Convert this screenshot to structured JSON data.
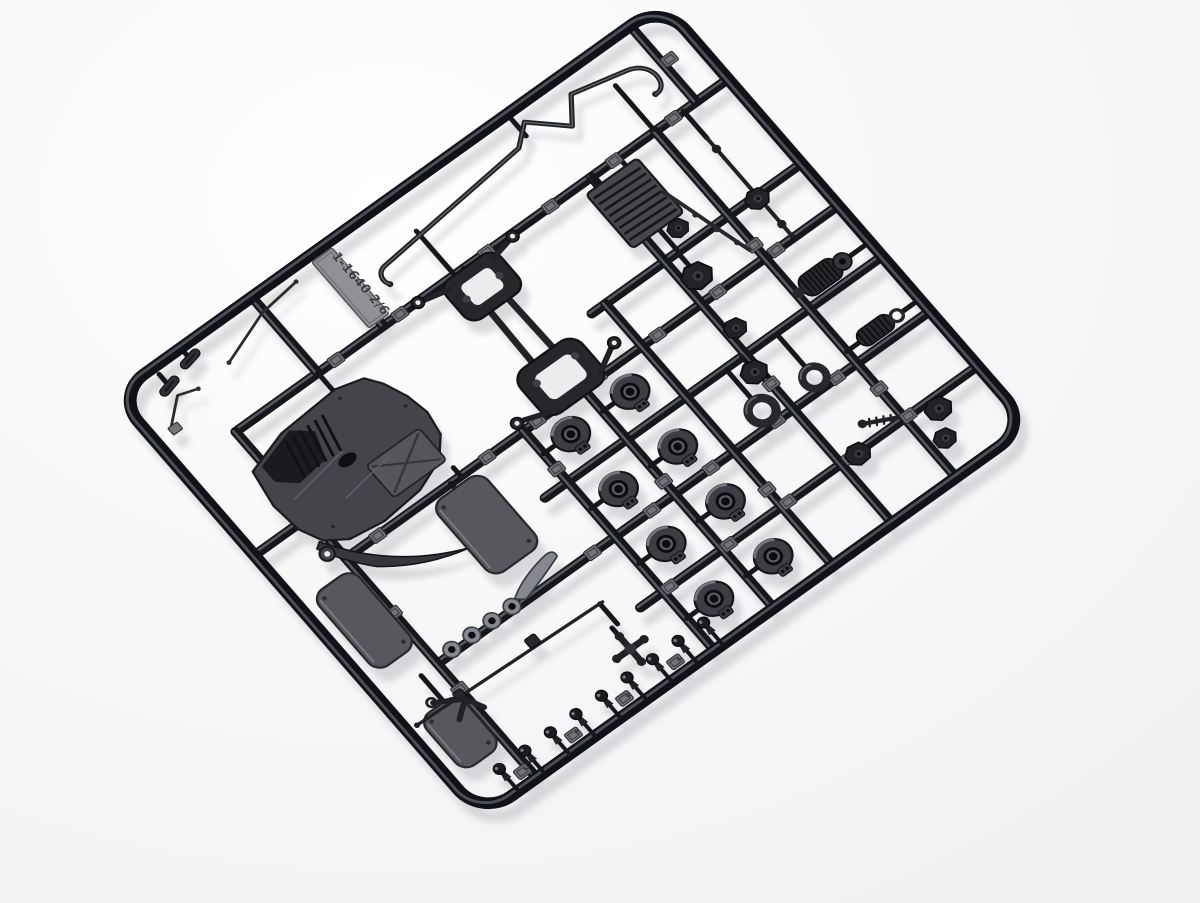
{
  "photo": {
    "description": "Black plastic model kit sprue with car chassis parts photographed on a white background",
    "tag_code": "1-1640 2/6",
    "pad_digits": [
      "2",
      "6",
      "9",
      "2"
    ]
  },
  "scene": {
    "width": 1200,
    "height": 903,
    "matrix": [
      0.9117,
      -0.6533,
      0.734,
      0.844,
      115,
      395
    ],
    "shadow_offset": [
      8,
      13
    ],
    "colors": {
      "bg_center": "#ffffff",
      "bg_edge": "#eff0f2",
      "shadow": "#b2b2b8",
      "runner": "#16171b",
      "runner_hi": "#565a62",
      "frame": "#111217",
      "dark": "#202226",
      "mid": "#34363b",
      "gray": "#46484d",
      "gray2": "#54565c",
      "light": "#7d8086",
      "pad": "#72747a",
      "pad_in": "#44464b",
      "tag_face": "#8f9195",
      "tag_text": "#3a3c40",
      "tag_emboss": "#c9cbcd",
      "cup": "#3c3e43",
      "cup_hi": "#73767d",
      "hole": "#0c0d10",
      "washer": "#85888e",
      "plate": "#56585d",
      "plate_hi": "#7b7e84",
      "bg_hole": "#ececee"
    },
    "frame": {
      "w": 600,
      "h": 500,
      "r": 32,
      "sw": 11
    },
    "runners": [
      [
        60,
        90,
        600,
        90
      ],
      [
        0,
        190,
        60,
        190
      ],
      [
        370,
        190,
        600,
        190
      ],
      [
        60,
        240,
        600,
        240
      ],
      [
        230,
        300,
        600,
        300
      ],
      [
        60,
        365,
        600,
        365
      ],
      [
        230,
        430,
        600,
        430
      ],
      [
        60,
        90,
        60,
        500
      ],
      [
        255,
        240,
        255,
        500
      ],
      [
        320,
        240,
        320,
        500
      ],
      [
        385,
        190,
        385,
        500
      ],
      [
        450,
        90,
        450,
        500
      ],
      [
        520,
        90,
        520,
        500
      ],
      [
        222,
        0,
        222,
        90
      ],
      [
        150,
        0,
        150,
        90
      ],
      [
        565,
        0,
        565,
        90
      ]
    ],
    "stubs": [
      [
        42,
        8,
        42,
        20
      ],
      [
        72,
        2,
        72,
        12
      ],
      [
        300,
        38,
        300,
        88
      ],
      [
        520,
        36,
        520,
        88
      ],
      [
        430,
        3,
        430,
        26
      ],
      [
        450,
        90,
        450,
        100
      ],
      [
        480,
        90,
        480,
        100
      ],
      [
        465,
        165,
        465,
        188
      ],
      [
        310,
        90,
        310,
        95
      ],
      [
        312,
        236,
        312,
        240
      ],
      [
        150,
        90,
        150,
        112
      ],
      [
        60,
        150,
        48,
        150
      ],
      [
        186,
        230,
        186,
        240
      ],
      [
        175,
        240,
        175,
        248
      ],
      [
        42,
        365,
        42,
        396
      ],
      [
        268,
        267,
        255,
        267
      ],
      [
        268,
        332,
        255,
        332
      ],
      [
        268,
        397,
        255,
        397
      ],
      [
        268,
        462,
        255,
        462
      ],
      [
        333,
        267,
        320,
        267
      ],
      [
        333,
        332,
        320,
        332
      ],
      [
        333,
        397,
        320,
        397
      ],
      [
        333,
        462,
        320,
        462
      ],
      [
        428,
        302,
        428,
        336
      ],
      [
        483,
        302,
        483,
        341
      ],
      [
        464,
        192,
        464,
        206
      ],
      [
        446,
        300,
        446,
        310
      ],
      [
        551,
        90,
        551,
        122
      ],
      [
        551,
        238,
        551,
        240
      ],
      [
        520,
        283,
        526,
        283
      ],
      [
        578,
        283,
        600,
        283
      ],
      [
        520,
        351,
        534,
        351
      ],
      [
        581,
        351,
        600,
        351
      ],
      [
        199,
        430,
        199,
        443
      ],
      [
        205,
        406,
        205,
        430
      ]
    ],
    "pads": [
      [
        170,
        90
      ],
      [
        240,
        90
      ],
      [
        335,
        90
      ],
      [
        405,
        90
      ],
      [
        475,
        90
      ],
      [
        540,
        90
      ],
      [
        95,
        240
      ],
      [
        215,
        240
      ],
      [
        270,
        240
      ],
      [
        337,
        240
      ],
      [
        402,
        240
      ],
      [
        468,
        240
      ],
      [
        532,
        240
      ],
      [
        230,
        365
      ],
      [
        295,
        365
      ],
      [
        360,
        365
      ],
      [
        432,
        365
      ],
      [
        498,
        365
      ],
      [
        262,
        430
      ],
      [
        327,
        430
      ],
      [
        392,
        430
      ],
      [
        460,
        430
      ],
      [
        524,
        430
      ],
      [
        60,
        140
      ],
      [
        60,
        305
      ],
      [
        60,
        395
      ],
      [
        255,
        285
      ],
      [
        320,
        350
      ],
      [
        385,
        410
      ],
      [
        450,
        155
      ],
      [
        520,
        225
      ],
      [
        450,
        335
      ],
      [
        520,
        395
      ],
      [
        572,
        45
      ],
      [
        54,
        488,
        0
      ],
      [
        110,
        488,
        1
      ],
      [
        166,
        488,
        2
      ],
      [
        222,
        488,
        3
      ]
    ],
    "tag": {
      "x": 211,
      "y": 6,
      "w": 22,
      "h": 78
    },
    "sway_bar": {
      "path": "M251,63 C247,57 249,49 257,47 L418,31 L437,15 L467,43 L485,19 L537,31 C549,34 556,44 553,56 C551,61 547,64 542,63",
      "tips": [
        [
          251,
          63
        ],
        [
          542,
          63
        ]
      ]
    },
    "wires": [
      {
        "path": "M96,36 L148,17 L189,12",
        "tips": [
          [
            96,
            36
          ],
          [
            189,
            12
          ]
        ]
      },
      {
        "path": "M20,52 L42,33 L60,39",
        "tips": [
          [
            60,
            39
          ]
        ],
        "pad": [
          16,
          52
        ]
      }
    ],
    "capsules": [
      [
        42,
        22,
        -14
      ],
      [
        72,
        13,
        -12
      ]
    ],
    "undertray": {
      "body": "M48,128 L90,115 L152,111 L178,118 L188,132 L197,154 L201,176 L197,199 L181,217 L150,229 L108,233 L74,228 L55,215 L45,194 L42,164 Z",
      "wing": "M52,214 Q86,272 150,297 Q108,288 76,262 Q56,240 46,218 Z",
      "cabin": "M57,129 L97,117 L114,131 L105,157 L73,161 L57,147 Z",
      "louver_count": 6,
      "inset": [
        128,
        183,
        58,
        38
      ],
      "oval": [
        119,
        169,
        9,
        5.5
      ],
      "eyelet": [
        50,
        227
      ],
      "screws": [
        [
          70,
          210
        ],
        [
          150,
          120
        ],
        [
          190,
          160
        ]
      ]
    },
    "spider": {
      "rails": [
        [
          303,
          116,
          301,
          206
        ],
        [
          322,
          116,
          324,
          206
        ]
      ],
      "upper_lobe": [
        282,
        90,
        60,
        46
      ],
      "upper_hole": [
        296,
        101,
        32,
        24
      ],
      "lower_lobe": [
        278,
        194,
        68,
        52
      ],
      "lower_hole": [
        292,
        206,
        40,
        28
      ],
      "arms": [
        [
          288,
          98,
          262,
          92
        ],
        [
          336,
          98,
          359,
          93
        ],
        [
          284,
          240,
          258,
          231
        ],
        [
          340,
          238,
          365,
          224
        ]
      ],
      "eyelets": [
        [
          259,
          91
        ],
        [
          362,
          92
        ],
        [
          255,
          231
        ],
        [
          368,
          223
        ]
      ],
      "bosses": [
        [
          294,
          114
        ],
        [
          330,
          114
        ],
        [
          292,
          212
        ],
        [
          334,
          212
        ]
      ]
    },
    "ribbed_plate": {
      "rect": [
        436,
        100,
        56,
        64
      ],
      "ribs": 8
    },
    "sill": {
      "path": "M490,139 C498,166 505,196 514,226",
      "nubs": [
        [
          493,
          152
        ],
        [
          498,
          172
        ],
        [
          504,
          194
        ],
        [
          510,
          214
        ]
      ]
    },
    "plates": [
      [
        14,
        250,
        44,
        90
      ],
      [
        148,
        246,
        54,
        86
      ],
      [
        14,
        396,
        42,
        62
      ]
    ],
    "cups": [
      [
        285,
        267
      ],
      [
        350,
        267
      ],
      [
        285,
        332
      ],
      [
        350,
        332
      ],
      [
        285,
        397
      ],
      [
        350,
        397
      ],
      [
        285,
        462
      ],
      [
        350,
        462
      ]
    ],
    "rings": [
      [
        428,
        350,
        15,
        9
      ],
      [
        483,
        353,
        13,
        8
      ]
    ],
    "washers": [
      [
        78,
        362
      ],
      [
        100,
        362
      ],
      [
        122,
        362
      ],
      [
        144,
        362
      ]
    ],
    "paddle": "M150,358 Q168,346 196,342 Q206,341 204,349 Q186,356 158,364 Z",
    "ball_posts": [
      40,
      68,
      96,
      124,
      152,
      180,
      208,
      236,
      264
    ],
    "cross_part": {
      "cx": 199,
      "cy": 455,
      "arm": 14
    },
    "long_rod": {
      "line": [
        10,
        399,
        208,
        406
      ],
      "fittings": [
        [
          52,
          399,
          9,
          9
        ],
        [
          132,
          398,
          11,
          10
        ]
      ],
      "tip": [
        10,
        399
      ]
    },
    "y_link": {
      "lines": [
        [
          34,
          391,
          58,
          405
        ],
        [
          58,
          405,
          66,
          421
        ],
        [
          58,
          405,
          42,
          417
        ]
      ],
      "ring": [
        33,
        390
      ]
    },
    "tie_rod": {
      "line": [
        551,
        122,
        551,
        238
      ],
      "bulges": [
        [
          551,
          135
        ],
        [
          551,
          224
        ]
      ]
    },
    "knuckles": [
      [
        464,
        218,
        1.15
      ],
      [
        446,
        318,
        1
      ],
      [
        468,
        432,
        0.95
      ],
      [
        549,
        441,
        1
      ],
      [
        536,
        466,
        0.85
      ],
      [
        550,
        193,
        0.9
      ],
      [
        479,
        173,
        0.8
      ],
      [
        459,
        276,
        0.85
      ]
    ],
    "ribbed_cyl": {
      "body": [
        526,
        272,
        40,
        22
      ],
      "cap": [
        570,
        283,
        8
      ],
      "nose": [
        522,
        283,
        5
      ]
    },
    "coilover": {
      "body": [
        534,
        342,
        36,
        17
      ],
      "eye": [
        575,
        351,
        5.5
      ]
    },
    "cv_axle": {
      "line": [
        488,
        412,
        516,
        426
      ],
      "ball": [
        488,
        412
      ],
      "ticks": 4
    }
  }
}
